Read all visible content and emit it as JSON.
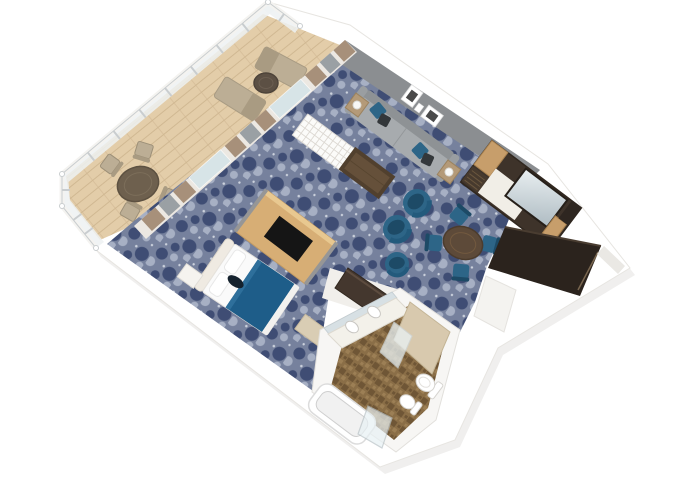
{
  "scene": {
    "type": "3d-floor-plan",
    "subject": "suite-with-private-balcony",
    "view": "top-down-isometric",
    "rooms": [
      {
        "name": "balcony",
        "furniture": [
          "round-patio-table",
          "patio-chair",
          "patio-chair",
          "patio-chair",
          "patio-chair",
          "sun-lounger",
          "sun-lounger",
          "small-round-side-table",
          "glass-railing"
        ]
      },
      {
        "name": "living-room",
        "furniture": [
          "sofa",
          "blue-throw-pillow",
          "dark-throw-pillow",
          "side-table-with-lamp",
          "side-table-with-lamp",
          "coffee-table",
          "white-lattice-bench",
          "tub-chair",
          "tub-chair",
          "ottoman",
          "round-dining-table",
          "dining-chair",
          "dining-chair",
          "dining-chair",
          "dining-chair",
          "wall-art-frame",
          "wall-art-frame",
          "media-wardrobe-unit-with-mirror"
        ]
      },
      {
        "name": "bedroom",
        "furniture": [
          "double-bed-with-blue-runner",
          "headboard",
          "pillow",
          "pillow",
          "nightstand",
          "foot-bench",
          "tv-divider-panel"
        ]
      },
      {
        "name": "bathroom",
        "furniture": [
          "double-sink-vanity",
          "vanity-mirror",
          "bathtub",
          "toilet",
          "bidet",
          "shower-partition",
          "glass-shower-door"
        ]
      },
      {
        "name": "entry-corridor",
        "furniture": [
          "entry-door",
          "dark-wardrobe-closet"
        ]
      }
    ]
  },
  "colors": {
    "background": "#ffffff",
    "shell": "#ffffff",
    "shell_stroke": "#e7e5e1",
    "shadow": "#c9c7c3",
    "wall_white": "#f7f7f5",
    "gray_wall": "#8b8e91",
    "wood_floor": "#e3cda9",
    "wood_line": "#d0b892",
    "railing_glass": "#edf1f2",
    "railing_frame": "#c9cdcf",
    "rail_white": "#f4f3f0",
    "carpet_base": "#76819d",
    "carpet_dark": "#3f4d74",
    "carpet_light": "#a7b0c4",
    "carpet_dot": "#ccd2dd",
    "curtain_tan": "#a7907a",
    "curtain_gray": "#9aa0a4",
    "glass": "#cfe3ea",
    "sofa_body": "#a7abae",
    "sofa_back": "#8e9295",
    "sofa_arm": "#9a9ea1",
    "pillow_blue": "#2d6587",
    "pillow_dark": "#33373a",
    "side_table": "#b49a78",
    "coffee_dark": "#51402e",
    "coffee_top": "#65503a",
    "bench_white": "#fbfbf9",
    "bench_grid": "#dcd8d2",
    "chair_blue": "#2d6587",
    "chair_blue_dark": "#1d4a66",
    "dining_wood": "#5d4a39",
    "dining_wood_rim": "#72593f",
    "wardrobe_dark": "#3e332a",
    "wardrobe_tan": "#c79e6b",
    "wardrobe_end": "#2e2620",
    "counter_white": "#f1eee7",
    "mirror_light": "#e9eff1",
    "mirror_dark": "#aebbc2",
    "corridor_dark": "#2b231d",
    "corridor_door": "#79664f",
    "threshold": "#eae8e4",
    "tv_wood": "#d7ae75",
    "tv_top": "#e8c890",
    "tv_screen": "#151515",
    "tv_edge": "#969696",
    "bed_white": "#fafafa",
    "bed_blue": "#1e5d89",
    "bed_blue_hi": "#2e6f9b",
    "headboard": "#efeae2",
    "bed_item": "#15222e",
    "nightstand": "#f5f3ef",
    "foot_bench": "#d9cdb4",
    "hall_floor": "#f1efeb",
    "closet_dark": "#44372e",
    "bath_wall": "#f7f6f4",
    "tile_base": "#8a6e47",
    "tile_dark": "#6f5636",
    "tile_light": "#9c7f55",
    "fixture": "#ffffff",
    "fixture_stroke": "#d6d4d0",
    "partition_tan": "#d8c9ae",
    "bath_glass": "#e8f1f4",
    "balcony_furn": "#bcae95",
    "balcony_furn_dark": "#a99b82",
    "balcony_table": "#6e604e",
    "balcony_small_table": "#5c5044"
  }
}
